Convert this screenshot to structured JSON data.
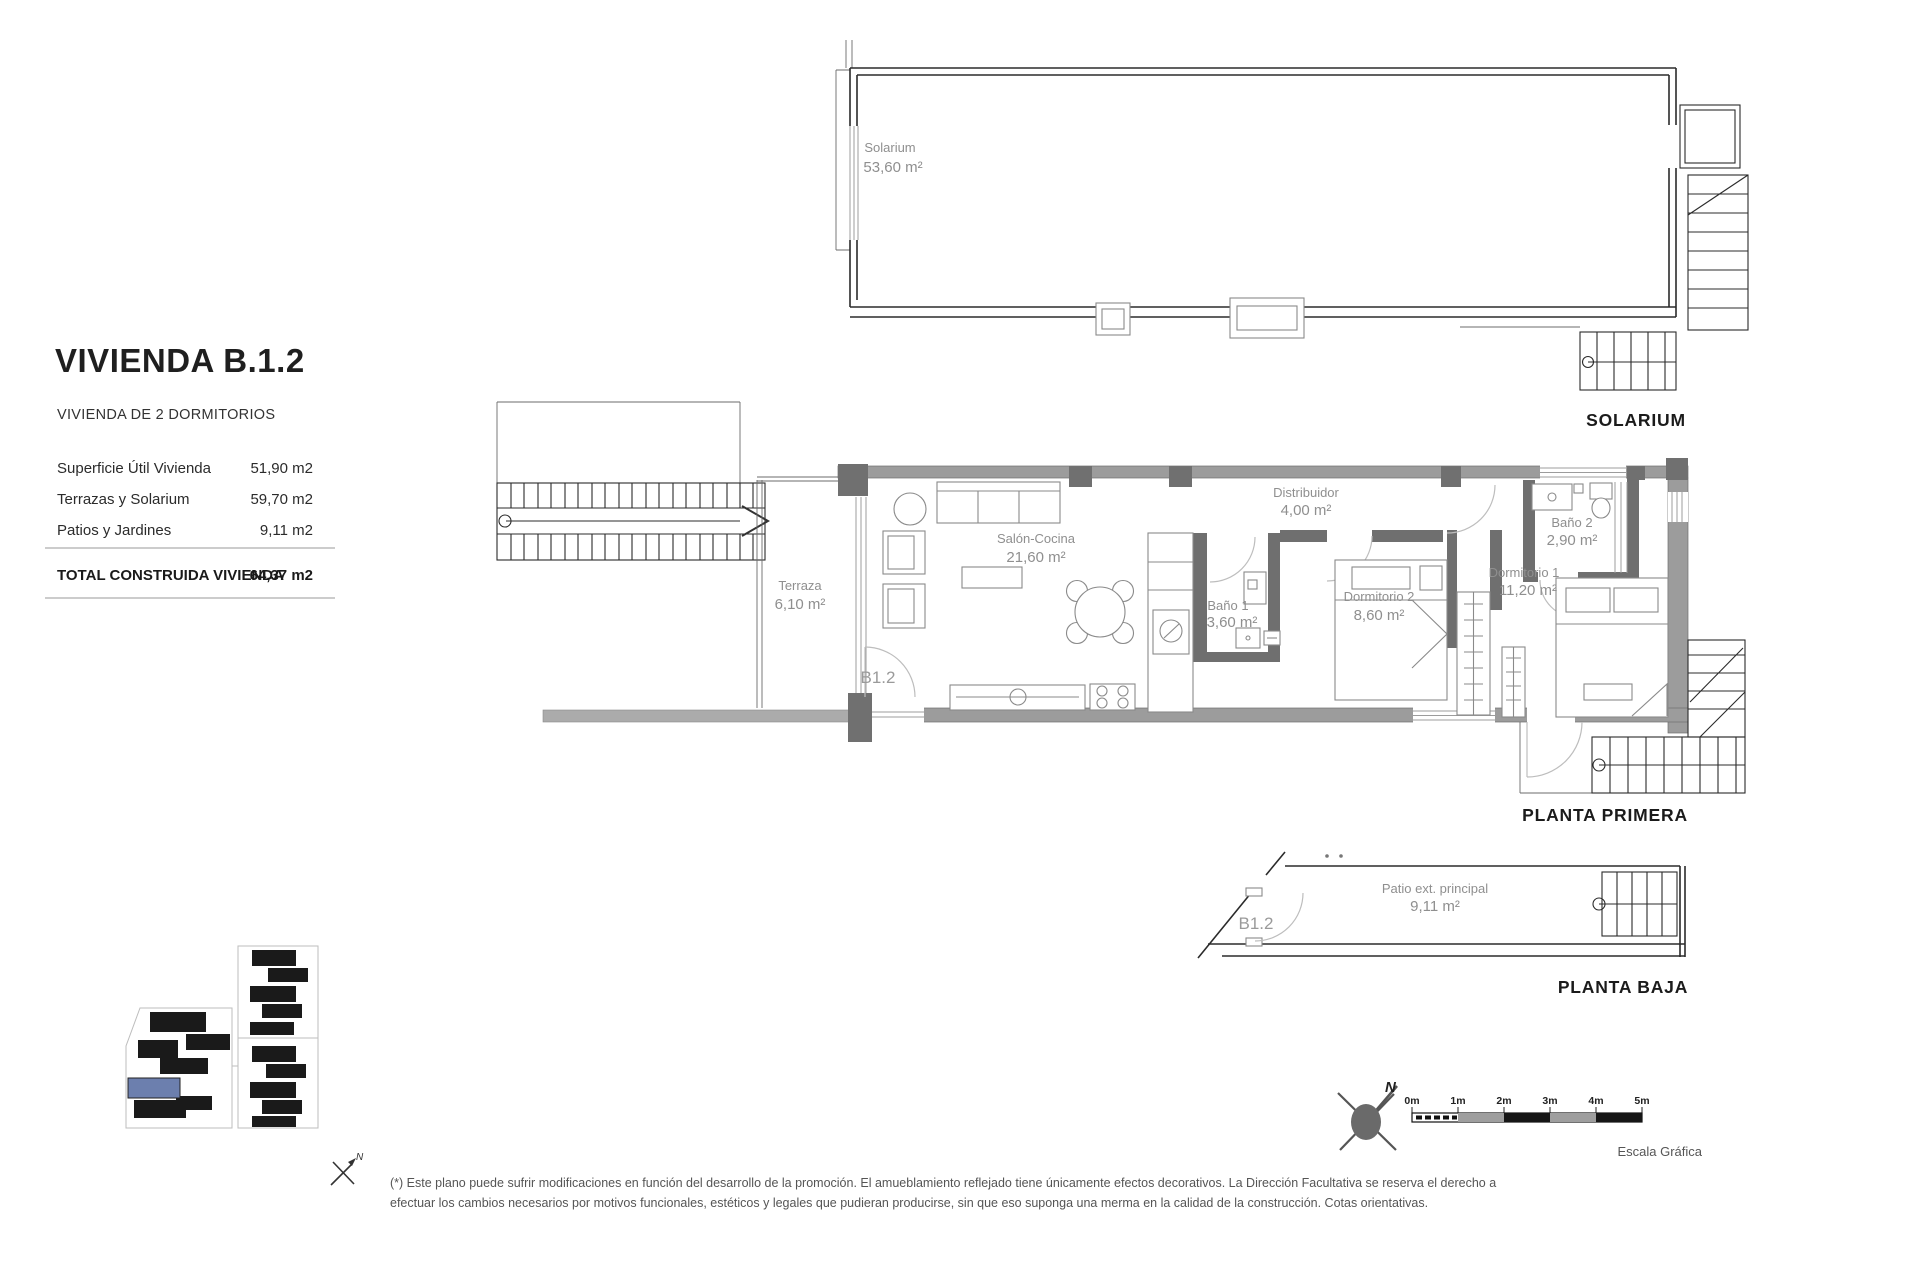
{
  "header": {
    "title": "VIVIENDA B.1.2",
    "subtitle": "VIVIENDA DE 2 DORMITORIOS",
    "area_rows": [
      {
        "label": "Superficie Útil Vivienda",
        "value": "51,90 m2"
      },
      {
        "label": "Terrazas y Solarium",
        "value": "59,70 m2"
      },
      {
        "label": "Patios y Jardines",
        "value": "9,11 m2"
      }
    ],
    "total_row": {
      "label": "TOTAL CONSTRUIDA VIVIENDA",
      "value": "64,37 m2"
    }
  },
  "plans": {
    "solarium": {
      "title": "SOLARIUM",
      "rooms": {
        "solarium": {
          "name": "Solarium",
          "area": "53,60 m²"
        }
      }
    },
    "planta_primera": {
      "title": "PLANTA PRIMERA",
      "unit_label": "B1.2",
      "rooms": {
        "terraza": {
          "name": "Terraza",
          "area": "6,10 m²"
        },
        "salon_cocina": {
          "name": "Salón-Cocina",
          "area": "21,60 m²"
        },
        "bano1": {
          "name": "Baño 1",
          "area": "3,60 m²"
        },
        "distribuidor": {
          "name": "Distribuidor",
          "area": "4,00 m²"
        },
        "dormitorio2": {
          "name": "Dormitorio 2",
          "area": "8,60 m²"
        },
        "bano2": {
          "name": "Baño 2",
          "area": "2,90 m²"
        },
        "dormitorio1": {
          "name": "Dormitorio 1",
          "area": "11,20 m²"
        }
      }
    },
    "planta_baja": {
      "title": "PLANTA BAJA",
      "unit_label": "B1.2",
      "rooms": {
        "patio": {
          "name": "Patio ext. principal",
          "area": "9,11 m²"
        }
      }
    }
  },
  "compass": {
    "north_label": "N"
  },
  "mini_compass": {
    "north_label": "N"
  },
  "scale_bar": {
    "ticks": [
      "0m",
      "1m",
      "2m",
      "3m",
      "4m",
      "5m"
    ],
    "caption": "Escala Gráfica"
  },
  "site_plan": {
    "highlight_color": "#6c7fae"
  },
  "disclaimer": {
    "line1": "(*) Este plano puede sufrir modificaciones en función del desarrollo de la promoción. El amueblamiento reflejado tiene únicamente efectos decorativos. La Dirección Facultativa se reserva el derecho a",
    "line2": "efectuar los cambios necesarios por motivos funcionales, estéticos y legales que pudieran producirse, sin que eso suponga una merma en la calidad de la construcción. Cotas orientativas."
  }
}
